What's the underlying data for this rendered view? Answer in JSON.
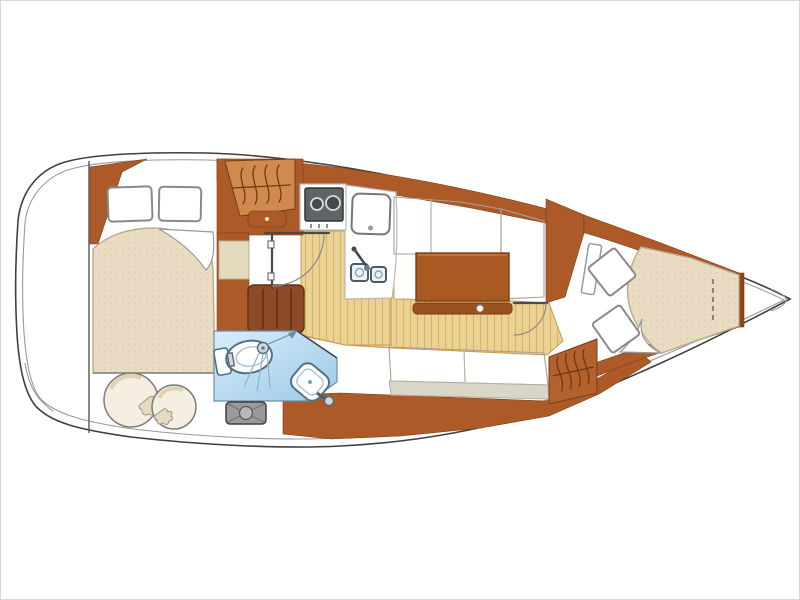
{
  "meta": {
    "description": "Sailboat interior layout floor plan, drawn horizontally with bow to the right and rounded stern to the left",
    "text_on_image": "none"
  },
  "palette": {
    "outline": "#3f3f3f",
    "inner": "#9a9a9a",
    "white": "#ffffff",
    "cabinet": "#ad5a29",
    "cabinet-edge": "#7c3d15",
    "locker": "#d18a4e",
    "bench": "#8d4a26",
    "bench-line": "#63300f",
    "table": "#a85a22",
    "table-edge": "#7e3c12",
    "rail": "#9a5120",
    "floor": "#ebd294",
    "floor-grain": "#d8b468",
    "settee": "#ded4b6",
    "settee-dot": "#c3b896",
    "fascia": "#d9d5c7",
    "mattress": "#e9dcc3",
    "mattress-dot": "#d8c8a8",
    "head1": "#d9edfa",
    "head2": "#9cc9e6",
    "fixture": "#4f7187",
    "hatch": "#9a9a9a",
    "stove": "#5f6567"
  },
  "areas": [
    {
      "id": "aft-cabin",
      "fixtures": [
        "double-berth",
        "pillow",
        "pillow",
        "turned-sheet-corner",
        "round-cushion",
        "round-cushion",
        "hanging-locker-symbol",
        "drawer"
      ]
    },
    {
      "id": "head",
      "fixtures": [
        "toilet",
        "shower-head-with-spray",
        "wash-basin-with-faucet",
        "arrow"
      ]
    },
    {
      "id": "companionway",
      "fixtures": [
        "door-with-swing-arc",
        "upholstered-bench",
        "deck-hatch"
      ]
    },
    {
      "id": "galley",
      "fixtures": [
        "two-burner-stove",
        "top-loading-fridge",
        "double-sink-with-faucet",
        "worktop"
      ]
    },
    {
      "id": "salon",
      "fixtures": [
        "l-shaped-port-settee",
        "saloon-table",
        "fiddle-rail-with-pedestal",
        "starboard-settee"
      ]
    },
    {
      "id": "forward-cabin",
      "fixtures": [
        "door-with-swing-arc",
        "open-door-leaf",
        "hanging-locker-symbol",
        "v-berth",
        "pillow",
        "pillow",
        "turned-sheet-corner",
        "dashed-bulkhead-line"
      ]
    },
    {
      "id": "bow-locker",
      "fixtures": []
    }
  ]
}
